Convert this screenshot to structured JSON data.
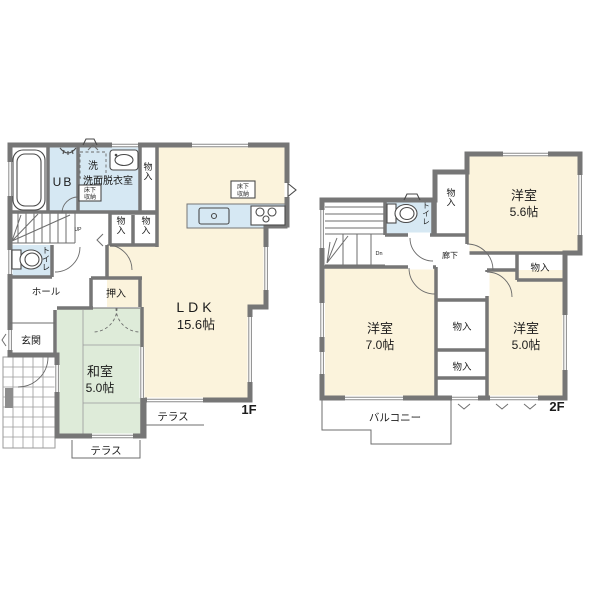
{
  "colors": {
    "room_cream": "#FBF3DC",
    "water_blue": "#D6E8F3",
    "tatami_green": "#DEEBD9",
    "wall_gray": "#767676"
  },
  "floor1": {
    "label": "1F",
    "ldk": {
      "name": "LDK",
      "area": "15.6帖"
    },
    "washitsu": {
      "name": "和室",
      "area": "5.0帖"
    },
    "ub": "UB",
    "washer": "洗",
    "senmen": "洗面脱衣室",
    "underfloor_wash": {
      "line1": "床下",
      "line2": "収納"
    },
    "underfloor_ldk": {
      "line1": "床下",
      "line2": "収納"
    },
    "closet_tall": "物入",
    "closet_a": "物入",
    "closet_b": "物入",
    "toilet": "トイレ",
    "hall": "ホール",
    "oshiire": "押入",
    "genkan": "玄関",
    "terrace_east": "テラス",
    "terrace_south": "テラス",
    "stairs": "UP"
  },
  "floor2": {
    "label": "2F",
    "room_ne": {
      "name": "洋室",
      "area": "5.6帖"
    },
    "room_sw": {
      "name": "洋室",
      "area": "7.0帖"
    },
    "room_se": {
      "name": "洋室",
      "area": "5.0帖"
    },
    "corridor": "廊下",
    "toilet": "トイレ",
    "closet_n": "物入",
    "closet_e": "物入",
    "closet_m1": "物入",
    "closet_m2": "物入",
    "balcony": "バルコニー",
    "stairs": "Dn"
  }
}
